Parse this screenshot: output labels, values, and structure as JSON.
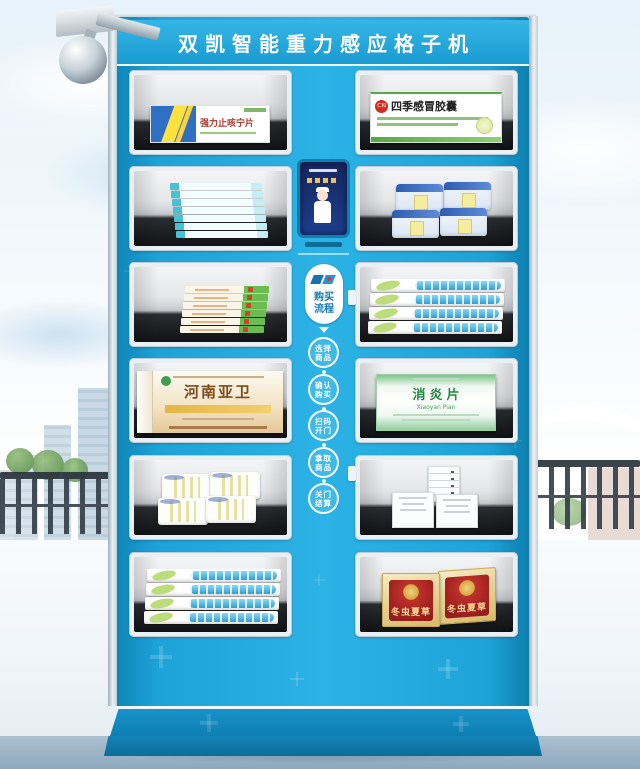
{
  "machine": {
    "title": "双凯智能重力感应格子机",
    "process": {
      "label_line1": "购买",
      "label_line2": "流程",
      "steps": [
        {
          "line1": "选择",
          "line2": "商品"
        },
        {
          "line1": "确认",
          "line2": "购买"
        },
        {
          "line1": "扫码",
          "line2": "开门"
        },
        {
          "line1": "拿取",
          "line2": "商品"
        },
        {
          "line1": "关门",
          "line2": "结算"
        }
      ]
    },
    "products": {
      "cough_tablets": {
        "name": "强力止咳宁片"
      },
      "cold_capsules": {
        "brand": "仁和",
        "name": "四季感冒胶囊"
      },
      "henan_yawei": {
        "name": "河南亚卫"
      },
      "xiaoyan_pian": {
        "name": "消炎片",
        "name_en": "Xiaoyan Pian"
      },
      "cordyceps": {
        "name": "冬虫夏草"
      }
    },
    "palette": {
      "cabinet_blue": "#1ea3d8",
      "frame_white": "#e9eff2",
      "shelf_dark": "#15171a",
      "accent_yellow": "#ffe23e",
      "banner_text": "#ffffff"
    }
  }
}
